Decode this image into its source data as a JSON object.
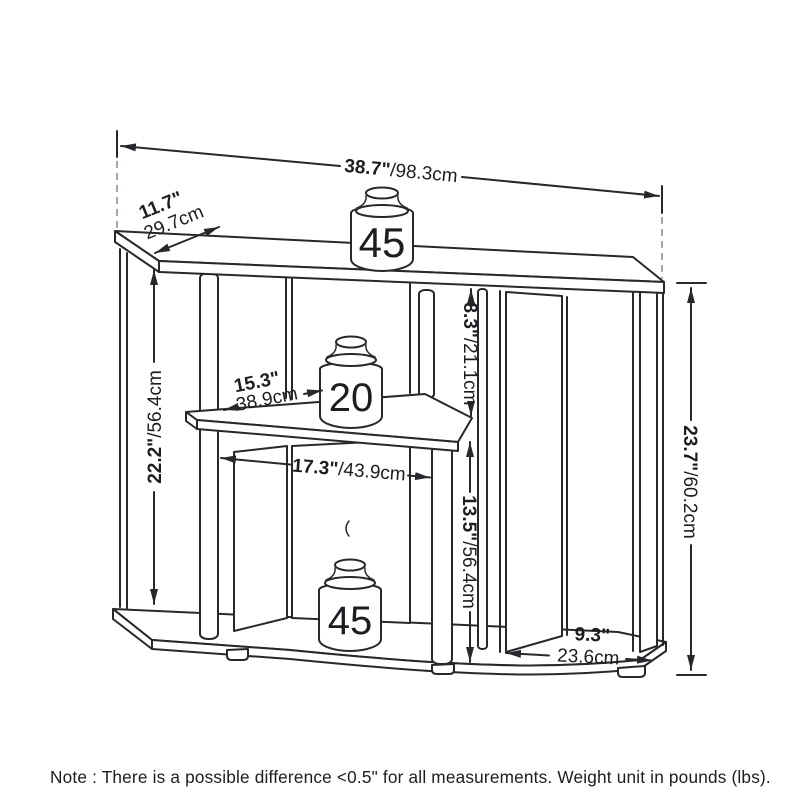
{
  "diagram": {
    "type": "furniture-dimension-drawing",
    "product": "3-tier corner TV stand",
    "note": "Note : There is a possible difference <0.5\" for all measurements. Weight unit in pounds (lbs).",
    "weight_capacities": {
      "top_shelf": "45",
      "middle_shelf": "20",
      "bottom_shelf": "45"
    },
    "dimensions": {
      "top_width": {
        "in": "38.7\"",
        "cm": "/98.3cm"
      },
      "top_side_depth": {
        "in": "11.7\"",
        "cm": "29.7cm"
      },
      "left_height": {
        "in": "22.2\"",
        "cm": "/56.4cm"
      },
      "top_to_middle_gap": {
        "in": "8.3\"",
        "cm": "/21.1cm"
      },
      "middle_shelf_width": {
        "in": "15.3\"",
        "cm": "38.9cm"
      },
      "inner_width": {
        "in": "17.3\"",
        "cm": "/43.9cm"
      },
      "middle_to_bottom_gap": {
        "in": "13.5\"",
        "cm": "/56.4cm"
      },
      "overall_height": {
        "in": "23.7\"",
        "cm": "/60.2cm"
      },
      "side_panel_depth": {
        "in": "9.3\"",
        "cm": "23.6cm"
      }
    },
    "colors": {
      "line": "#26282c",
      "dash": "#9aa0a4",
      "text": "#1b1d21"
    }
  }
}
